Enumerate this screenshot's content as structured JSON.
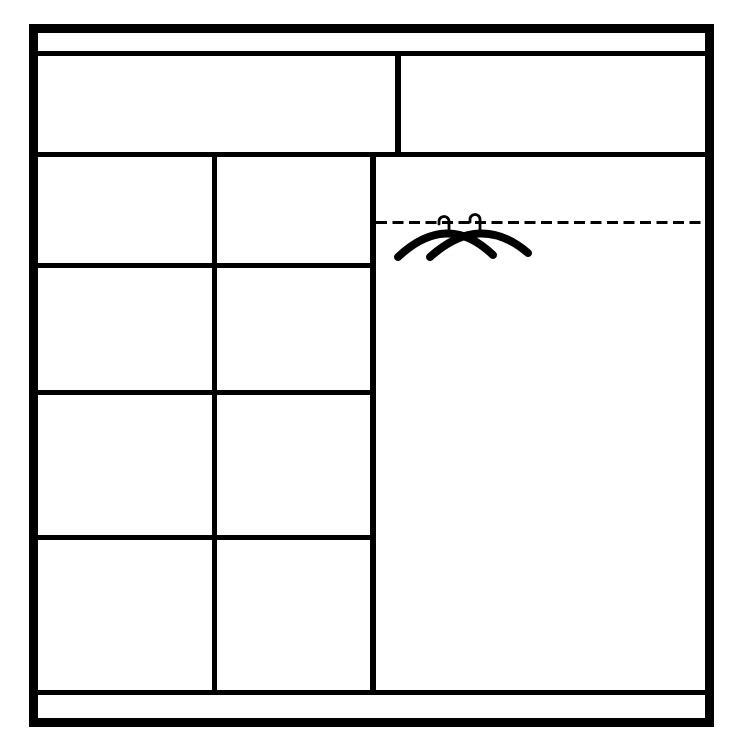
{
  "diagram": {
    "type": "wardrobe-interior-layout-diagram",
    "background_color": "#ffffff",
    "line_color": "#000000",
    "frame": {
      "style": "thick-black-outline",
      "top_panel_strip": true,
      "bottom_panel_strip": true
    },
    "top_row": {
      "compartments": 2,
      "left_compartment": "wide top shelf compartment",
      "right_compartment": "top shelf compartment above hanging area"
    },
    "left_section": {
      "shelf_columns": 2,
      "shelf_rows": 4
    },
    "right_section": {
      "hanging_area": true,
      "rail_style": "dashed",
      "hanger_icon_count": 2,
      "hanger_icon": "clothes-hanger-icon"
    }
  }
}
